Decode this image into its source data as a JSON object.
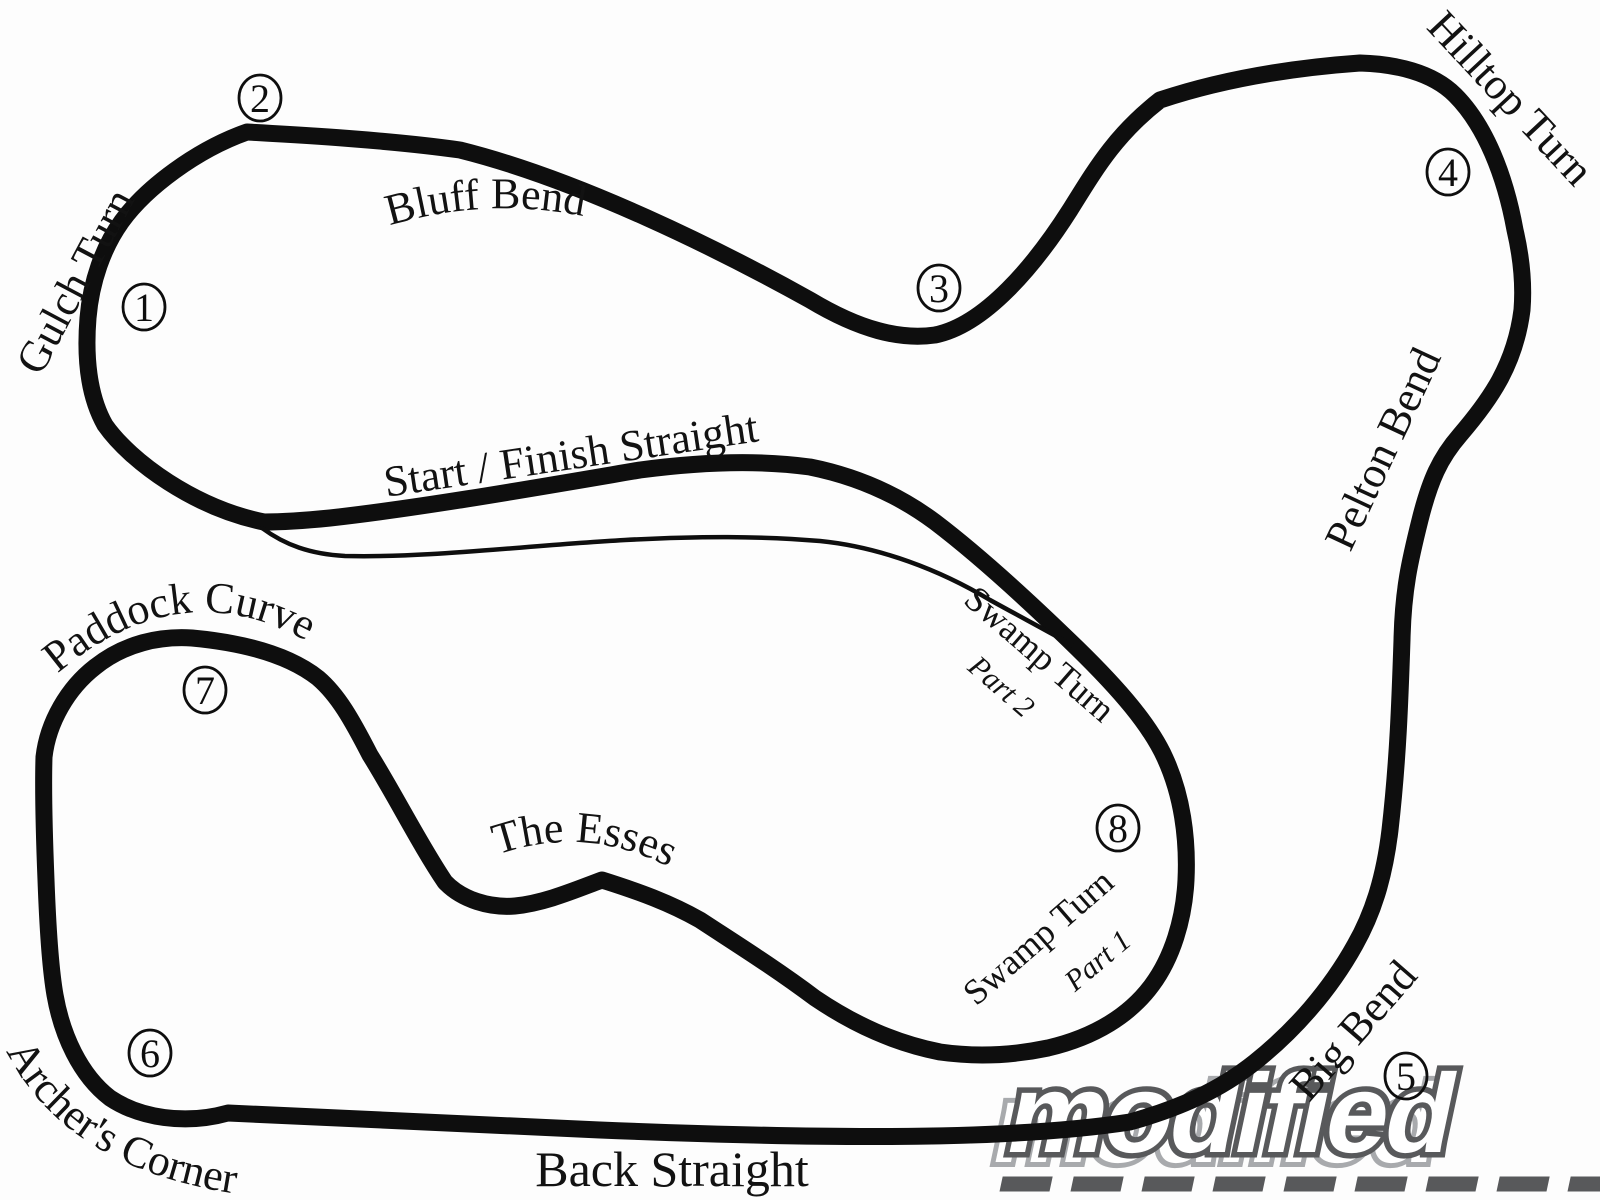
{
  "map": {
    "corner_labels": {
      "gulch_turn": "Gulch Turn",
      "bluff_bend": "Bluff Bend",
      "start_finish_straight": "Start / Finish Straight",
      "hilltop_turn": "Hilltop Turn",
      "pelton_bend": "Pelton Bend",
      "swamp_turn_part2_line1": "Swamp Turn",
      "swamp_turn_part2_line2": "Part 2",
      "swamp_turn_part1_line1": "Swamp Turn",
      "swamp_turn_part1_line2": "Part 1",
      "big_bend": "Big Bend",
      "back_straight": "Back Straight",
      "archers_corner": "Archer's Corner",
      "paddock_curve": "Paddock Curve",
      "the_esses": "The Esses"
    },
    "turn_numbers": [
      "1",
      "2",
      "3",
      "4",
      "5",
      "6",
      "7",
      "8"
    ]
  },
  "watermark": {
    "logo_text": "modified"
  },
  "colors": {
    "track": "#0e0e0e",
    "background": "#ffffff",
    "logo_outline": "#58595b",
    "logo_light": "#a8aaad",
    "logo_fill": "#ffffff"
  }
}
